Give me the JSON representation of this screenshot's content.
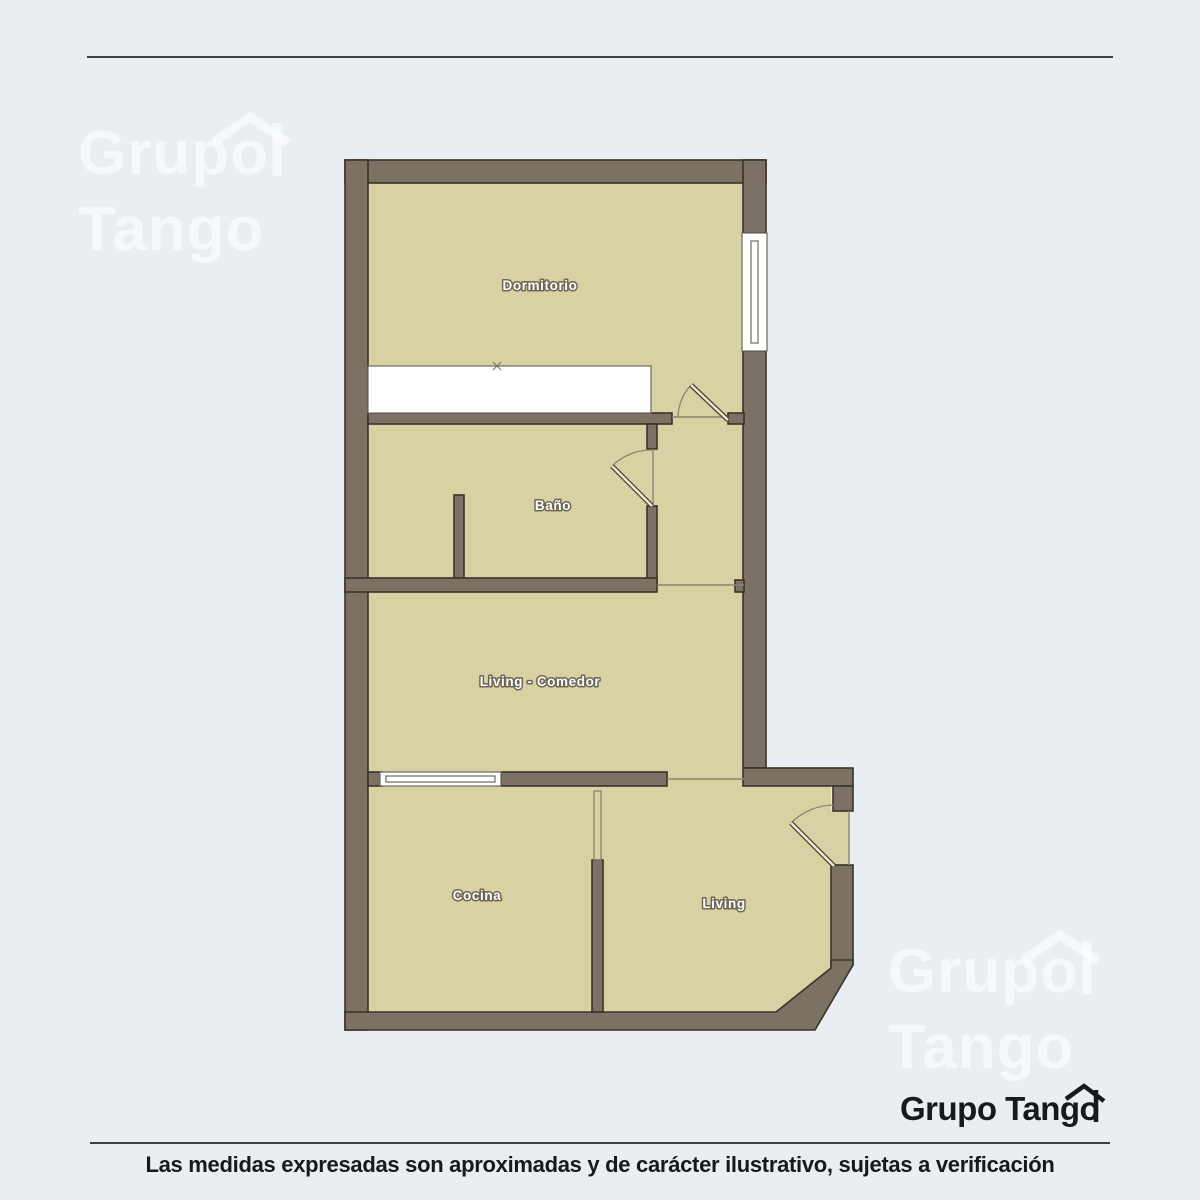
{
  "page": {
    "background_color": "#e9eef2"
  },
  "watermark": {
    "line1": "Grupo",
    "line2": "Tango"
  },
  "plan": {
    "colors": {
      "wall": "#7b7265",
      "floor": "#d8d1a3",
      "window_fill": "#ffffff",
      "label_fill": "#ffffff"
    },
    "rooms": [
      {
        "label": "Dormitorio"
      },
      {
        "label": "Baño"
      },
      {
        "label": "Living - Comedor"
      },
      {
        "label": "Cocina"
      },
      {
        "label": "Living"
      }
    ]
  },
  "footer": {
    "logo_text": "Grupo Tango",
    "disclaimer": "Las medidas expresadas son aproximadas y de carácter ilustrativo, sujetas a verificación"
  }
}
